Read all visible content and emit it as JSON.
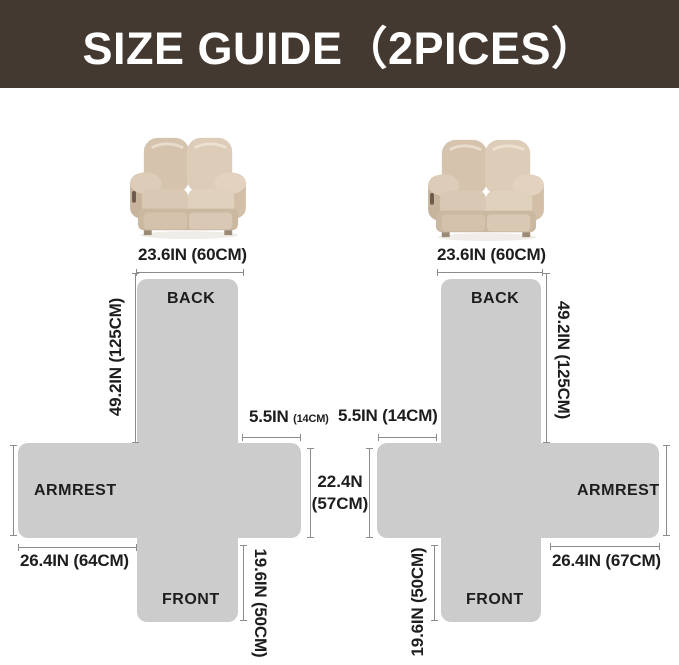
{
  "header": {
    "title": "SIZE GUIDE（2PICES）"
  },
  "colors": {
    "header_bg": "#443931",
    "header_text": "#ffffff",
    "piece_gray": "#cccccc",
    "line_gray": "#8c8c8c",
    "text_dark": "#1d1d1d",
    "sofa_beige": "#d8c6b1"
  },
  "left": {
    "top_width": "23.6IN (60CM)",
    "back_label": "BACK",
    "armrest_label": "ARMREST",
    "front_label": "FRONT",
    "back_height": "49.2IN (125CM)",
    "gap_main": "5.5IN",
    "gap_sub": "(14CM)",
    "armrest_length": "26.4IN (64CM)",
    "front_length": "19.6IN (50CM)"
  },
  "middle": {
    "seat_width_line1": "22.4N",
    "seat_width_line2": "(57CM)"
  },
  "right": {
    "top_width": "23.6IN (60CM)",
    "back_label": "BACK",
    "armrest_label": "ARMREST",
    "front_label": "FRONT",
    "back_height": "49.2IN (125CM)",
    "gap": "5.5IN (14CM)",
    "armrest_length": "26.4IN (67CM)",
    "front_length": "19.6IN (50CM)"
  }
}
